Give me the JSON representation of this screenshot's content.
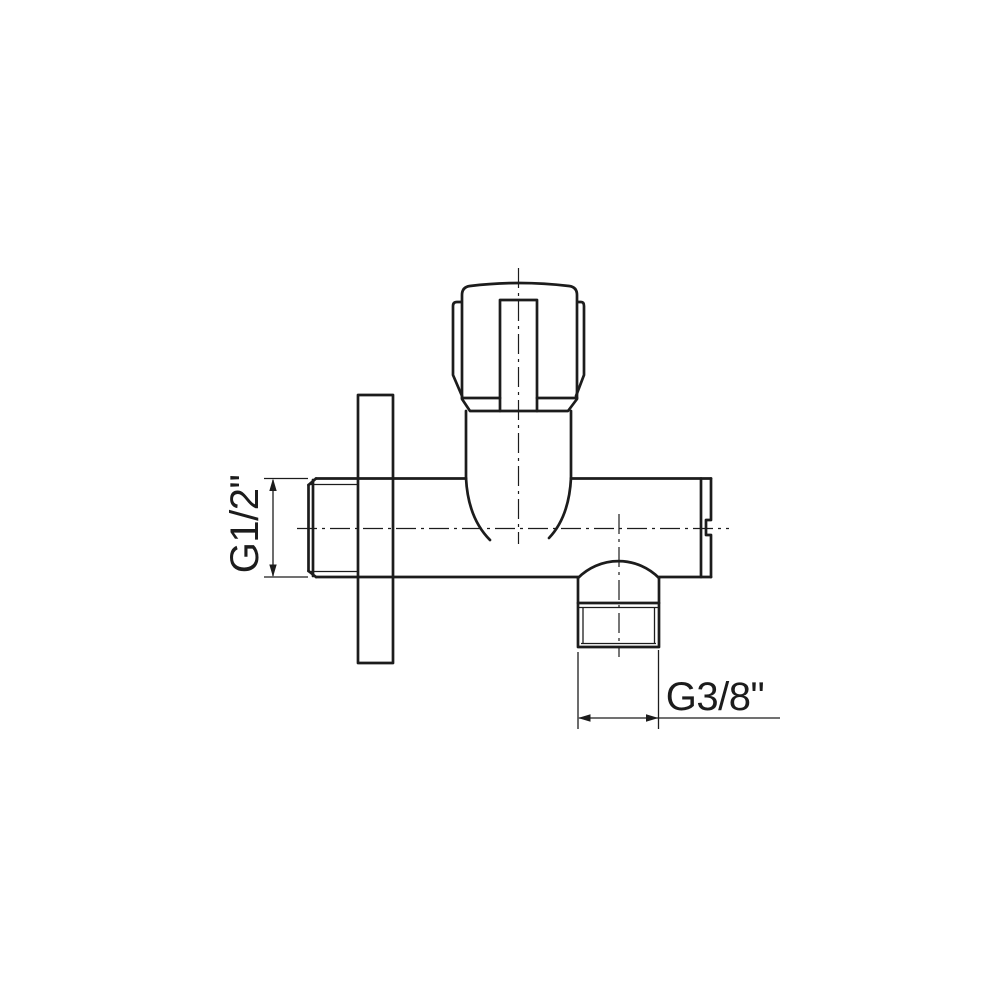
{
  "diagram": {
    "kind": "technical-drawing",
    "subject": "angle-valve-side-view",
    "labels": {
      "inlet_thread": "G1/2\"",
      "outlet_thread": "G3/8\""
    },
    "colors": {
      "line": "#1c1c1c",
      "background": "#ffffff"
    }
  }
}
